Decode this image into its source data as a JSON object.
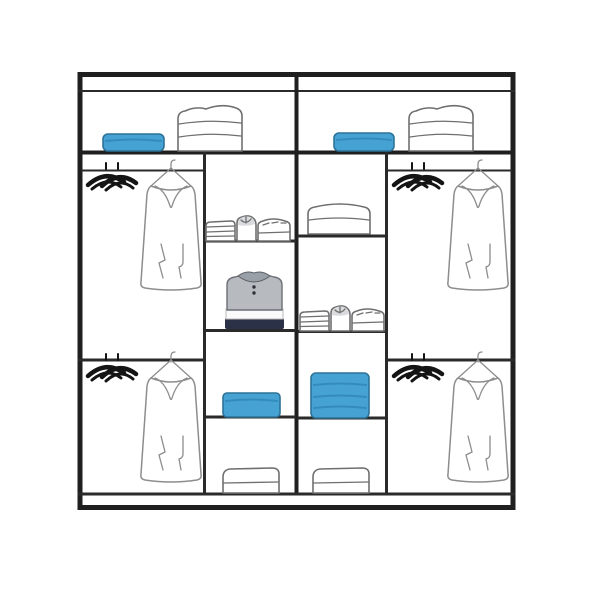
{
  "image": {
    "kind": "wardrobe-interior-layout-line-drawing",
    "background": "#ffffff"
  },
  "colors": {
    "background": "#ffffff",
    "frame_line": "#1f1f1f",
    "shelf_line": "#2a2a2a",
    "soft_outline": "#6f6f6f",
    "garment_outline": "#8d8d8d",
    "hanger_black": "#141414",
    "accent_blue": "#47a2d4",
    "accent_blue_edge": "#2c7298",
    "accent_blue_line": "#338bbc",
    "shirt_gray": "#b7bbc0",
    "shirt_collar_gray": "#9aa0a8",
    "shirt_navy": "#2b3147",
    "shirt_button": "#2e3238"
  },
  "wardrobe": {
    "top_shelf": {
      "left_items": [
        "blue-storage-box",
        "folded-linen-stack"
      ],
      "right_items": [
        "blue-storage-box",
        "folded-linen-stack"
      ]
    },
    "left_section": {
      "top": [
        "black-hangers",
        "garment-on-hanger"
      ],
      "bottom": [
        "black-hangers",
        "garment-on-hanger"
      ]
    },
    "right_section": {
      "top": [
        "black-hangers",
        "garment-on-hanger"
      ],
      "bottom": [
        "black-hangers",
        "garment-on-hanger"
      ]
    },
    "center_left_column": [
      "folded-towel-group",
      "folded-polo-shirt",
      "blue-storage-box-short",
      "folded-item"
    ],
    "center_right_column": [
      "folded-duvet",
      "folded-towel-group-with-shirt",
      "blue-storage-box-tall",
      "folded-item"
    ]
  }
}
